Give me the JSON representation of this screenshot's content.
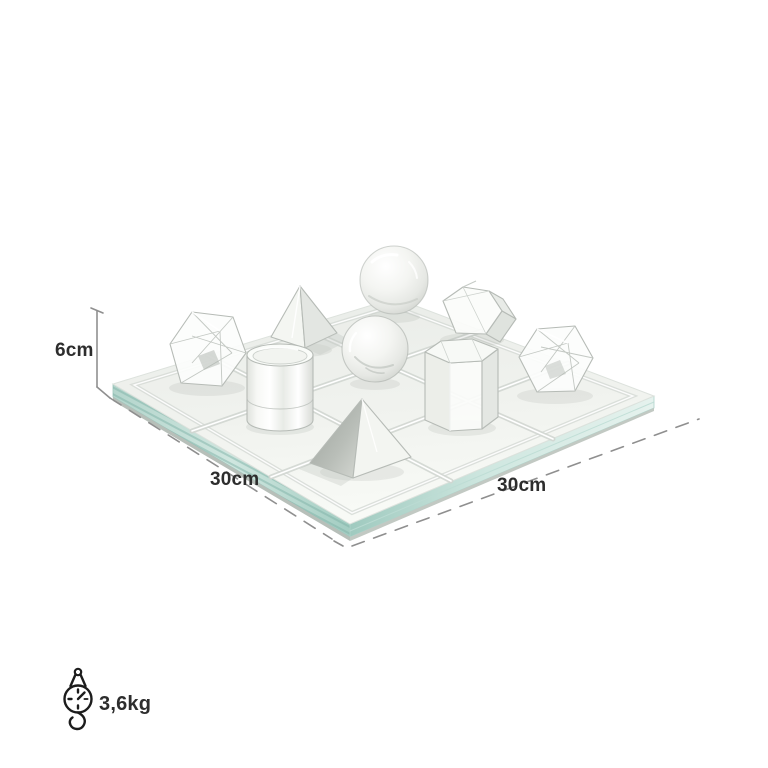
{
  "page": {
    "background": "#ffffff"
  },
  "product": {
    "description": "Clear glass crystal tic-tac-toe game board with geometric crystal playing pieces",
    "board": {
      "rows": 3,
      "cols": 3,
      "material_tint": "#bcd9d1"
    },
    "pieces": [
      "faceted-diamond-left",
      "pointed-pyramid-upper",
      "cylinder",
      "sphere-top",
      "sphere-middle",
      "pyramid-lower",
      "hexagonal-prism-top-right",
      "hexagonal-prism-middle-right",
      "faceted-diamond-right"
    ]
  },
  "annotations": {
    "height": {
      "label": "6cm"
    },
    "width_left": {
      "label": "30cm"
    },
    "depth_right": {
      "label": "30cm"
    },
    "weight": {
      "label": "3,6kg",
      "icon": "hanging-scale-icon"
    }
  },
  "colors": {
    "text": "#2d2d2d",
    "dimension_line": "#8f8f8f",
    "icon_stroke": "#1c1c1c",
    "glass_edge": "#a8cfc5",
    "glass_surface": "#eef1ed",
    "crystal_stroke": "#b6bbb6"
  }
}
